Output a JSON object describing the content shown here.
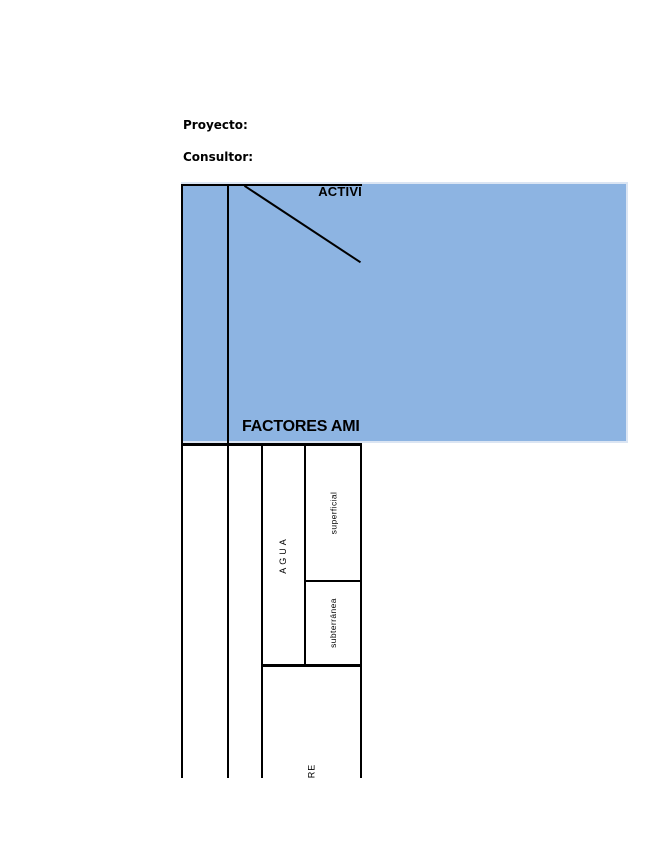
{
  "document": {
    "proyecto_label": "Proyecto:",
    "consultor_label": "Consultor:"
  },
  "matrix": {
    "activities_header": "ACTIVI",
    "factors_header": "FACTORES AMI",
    "factor_groups": [
      {
        "label": "AGUA",
        "subfactors": [
          "superficial",
          "subterránea"
        ]
      },
      {
        "label": "RE",
        "subfactors": []
      }
    ],
    "colors": {
      "header_fill": "#8db4e2",
      "header_edge": "#dbe5f3",
      "grid_line": "#000000"
    }
  }
}
